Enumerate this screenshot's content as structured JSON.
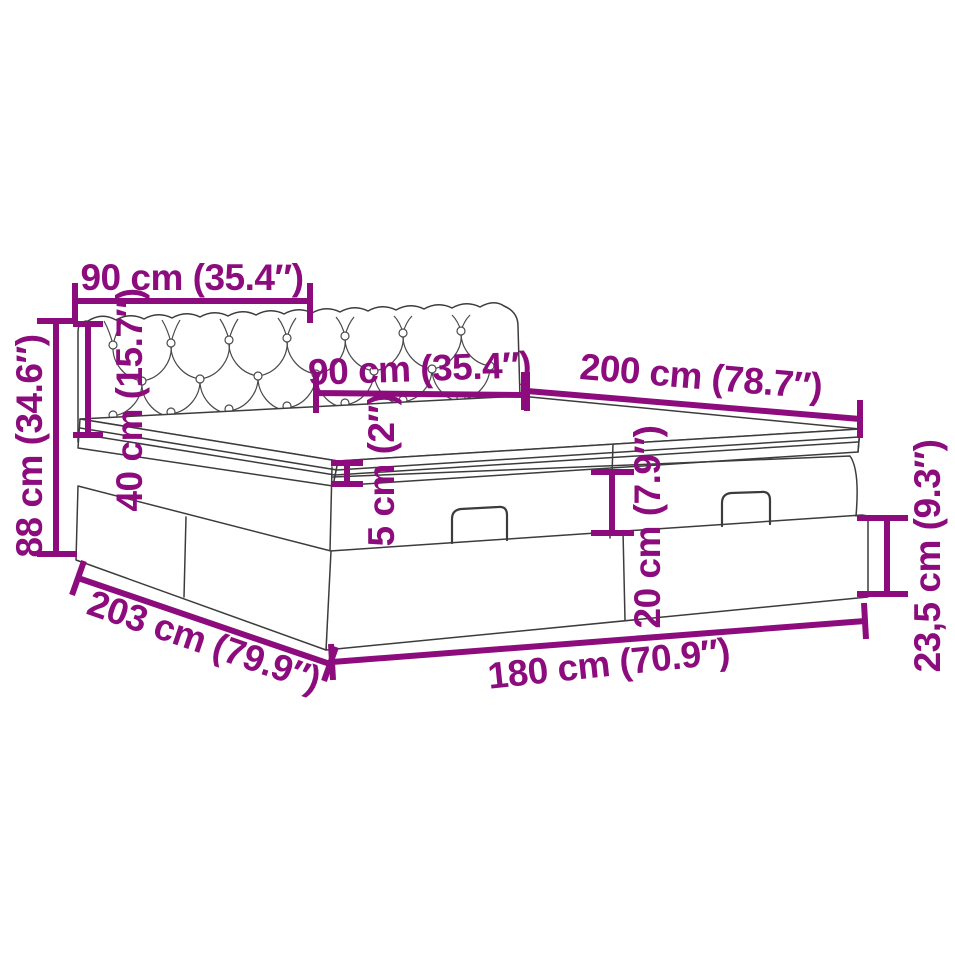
{
  "page": {
    "title": "Bed dimension diagram",
    "background": "#ffffff"
  },
  "diagram": {
    "subject": "Ottoman storage bed with tufted headboard, split lift-up top boxes and two handles",
    "style": {
      "accent_color": "#8c0c7d",
      "line_color": "#3c3c3c"
    },
    "dimensions": [
      {
        "id": "headboard-width-left-half",
        "cm": "90",
        "inches": "35.4",
        "label": "90 cm (35.4″)"
      },
      {
        "id": "headboard-width-right-half",
        "cm": "90",
        "inches": "35.4",
        "label": "90 cm (35.4″)"
      },
      {
        "id": "bed-length",
        "cm": "200",
        "inches": "78.7",
        "label": "200 cm (78.7″)"
      },
      {
        "id": "total-height",
        "cm": "88",
        "inches": "34.6",
        "label": "88 cm (34.6″)"
      },
      {
        "id": "headboard-height",
        "cm": "40",
        "inches": "15.7",
        "label": "40 cm (15.7″)"
      },
      {
        "id": "mattress-topper-thickness",
        "cm": "5",
        "inches": "2",
        "label": "5 cm (2″)"
      },
      {
        "id": "upper-box-height",
        "cm": "20",
        "inches": "7.9",
        "label": "20 cm (7.9″)"
      },
      {
        "id": "lower-box-height",
        "cm": "23,5",
        "inches": "9.3",
        "label": "23,5 cm (9.3″)"
      },
      {
        "id": "frame-total-length",
        "cm": "203",
        "inches": "79.9",
        "label": "203 cm (79.9″)"
      },
      {
        "id": "frame-width",
        "cm": "180",
        "inches": "70.9",
        "label": "180 cm (70.9″)"
      }
    ]
  }
}
